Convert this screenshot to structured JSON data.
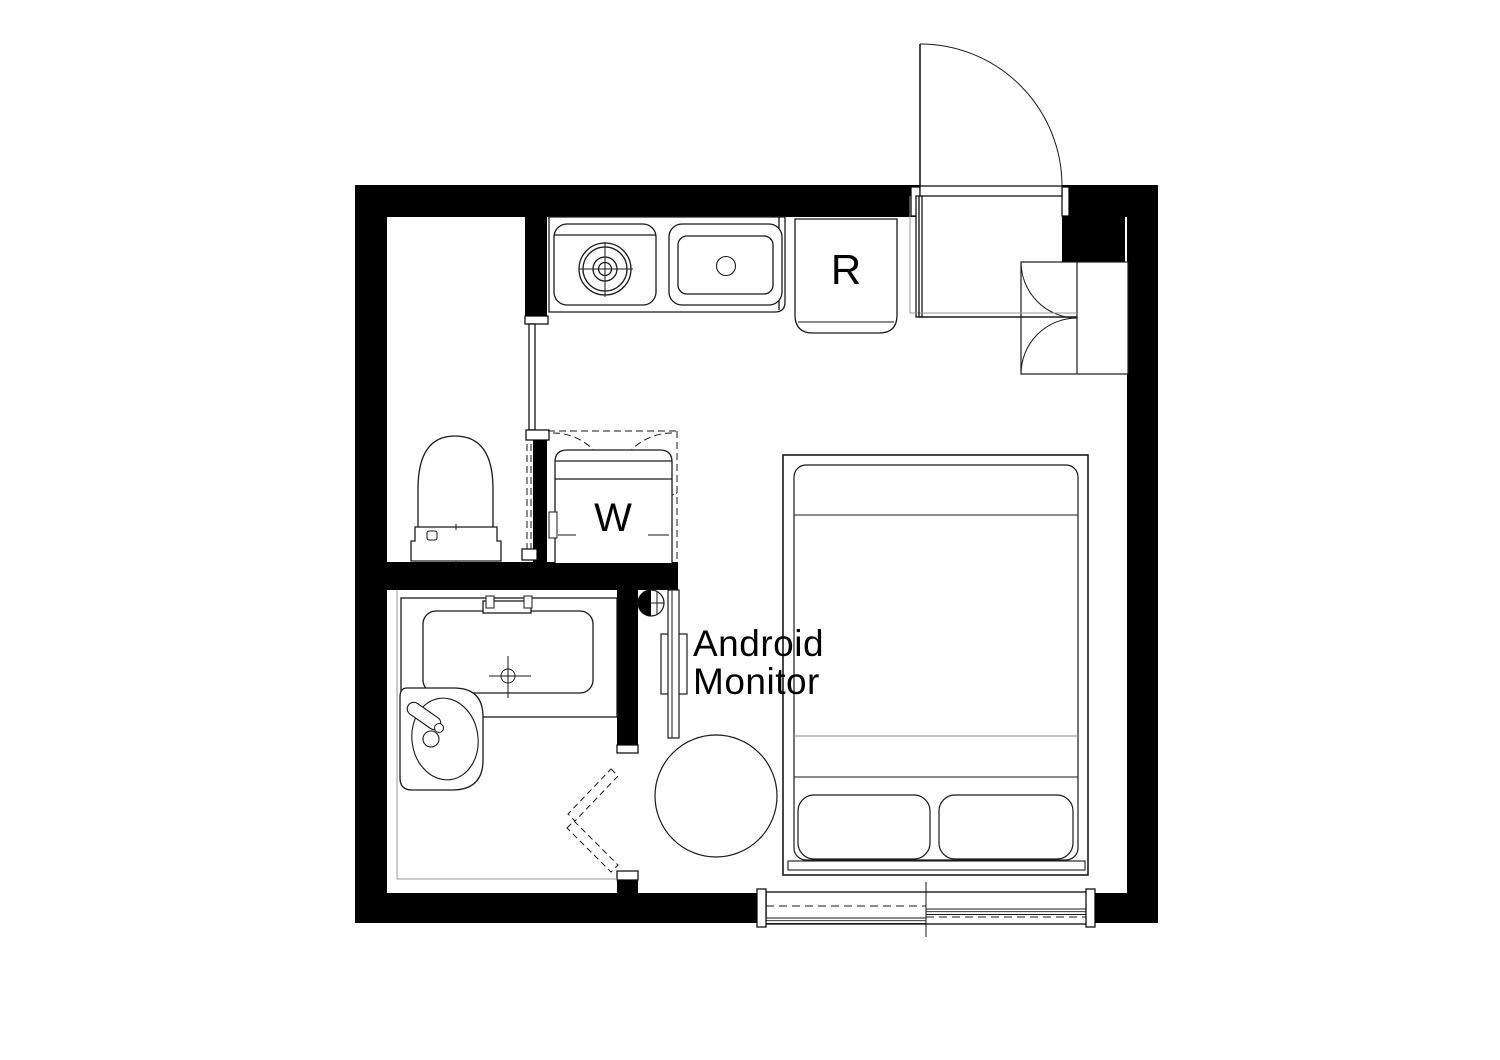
{
  "plan": {
    "labels": {
      "refrigerator": "R",
      "washing_machine": "W",
      "monitor_line1": "Android",
      "monitor_line2": "Monitor"
    },
    "colors": {
      "wall": "#000000",
      "line": "#1a1a1a",
      "muted_line": "#999999",
      "background": "#ffffff"
    },
    "fixtures": [
      "entrance-door",
      "shoe-cabinet",
      "refrigerator",
      "kitchen-counter",
      "stove-burner",
      "kitchen-sink",
      "washing-machine-closet",
      "toilet",
      "bathtub",
      "washbasin",
      "folding-door",
      "wall-monitor",
      "datum-marker",
      "round-table",
      "double-bed",
      "pillows",
      "sliding-window"
    ]
  }
}
